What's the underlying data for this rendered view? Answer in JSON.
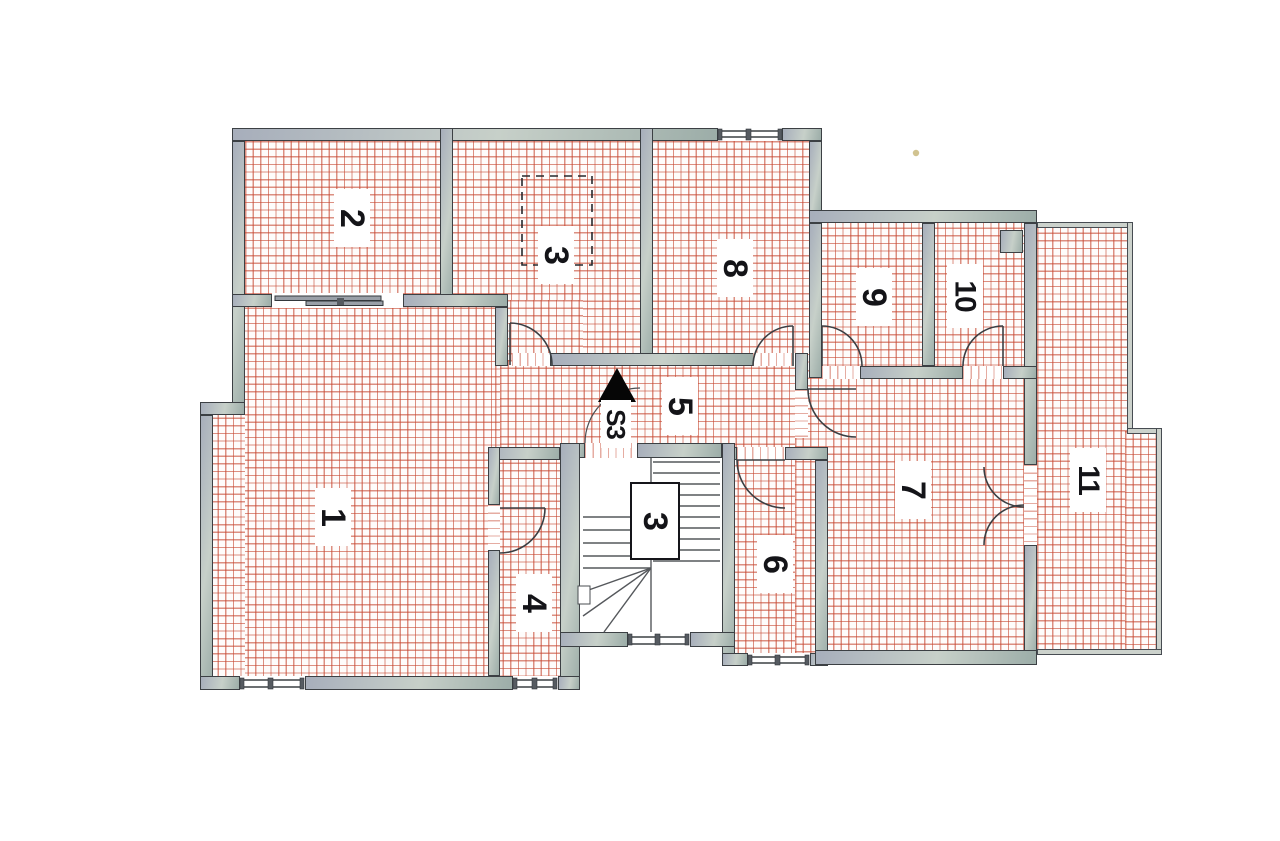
{
  "plan": {
    "kind": "apartment-floor-plan",
    "rooms": [
      {
        "id": 1,
        "label": "1"
      },
      {
        "id": 2,
        "label": "2"
      },
      {
        "id": 3,
        "label": "3"
      },
      {
        "id": 4,
        "label": "4"
      },
      {
        "id": 5,
        "label": "5"
      },
      {
        "id": 6,
        "label": "6"
      },
      {
        "id": 7,
        "label": "7"
      },
      {
        "id": 8,
        "label": "8"
      },
      {
        "id": 9,
        "label": "9"
      },
      {
        "id": 10,
        "label": "10"
      },
      {
        "id": 11,
        "label": "11"
      }
    ],
    "stairwell": {
      "room_label": "3",
      "staircase_code": "S3"
    },
    "colors": {
      "hatch_red": "#c64630",
      "wall_fill_light": "#c7d0c9",
      "wall_fill_dark": "#a7aebb",
      "wall_outline": "#3c4044",
      "label_text": "#141418",
      "paper": "#ffffff"
    }
  }
}
